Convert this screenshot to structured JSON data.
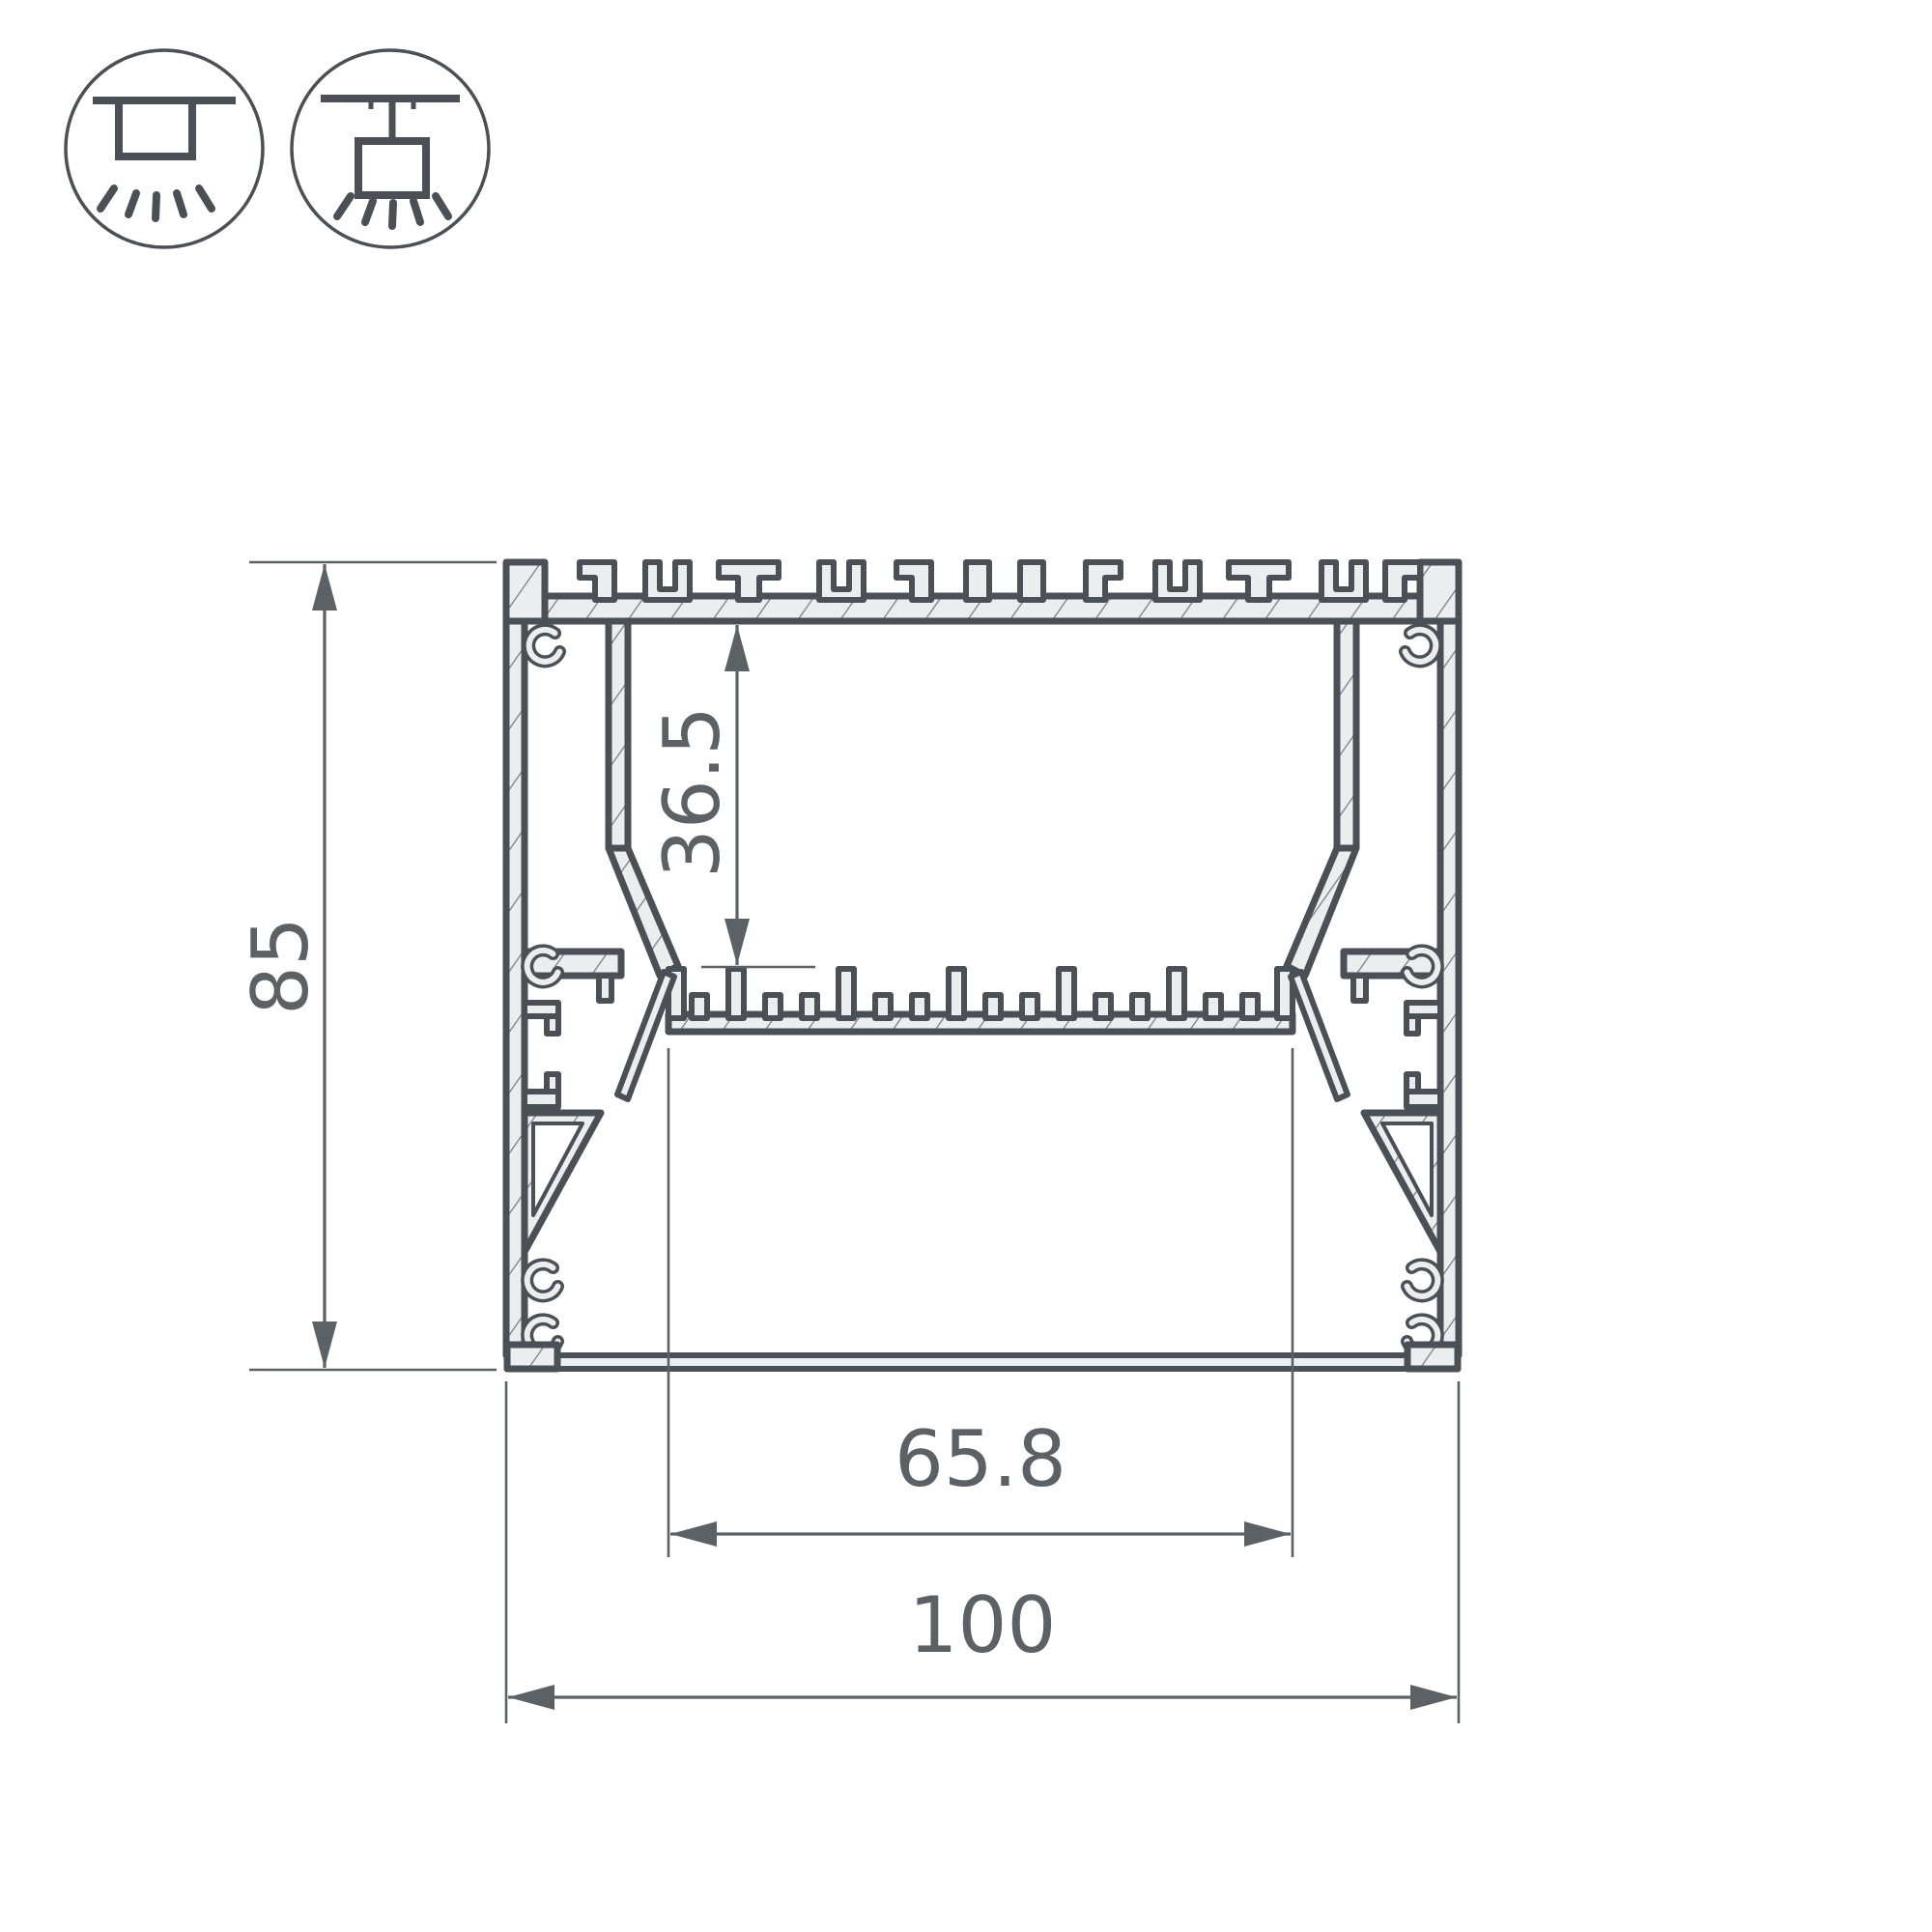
{
  "page": {
    "background": "#ffffff"
  },
  "icons": {
    "items": [
      {
        "name": "surface-ceiling-mount"
      },
      {
        "name": "pendant-suspension-mount"
      }
    ]
  },
  "drawing": {
    "type": "aluminum-led-profile-cross-section",
    "colors": {
      "outline": "#4a5056",
      "material_fill": "#ecedee",
      "hatch_line": "#767c81",
      "dimension_line": "#5c6166"
    },
    "dimensions": {
      "overall_height": {
        "label": "85"
      },
      "cavity_depth": {
        "label": "36.5"
      },
      "opening_width": {
        "label": "65.8"
      },
      "overall_width": {
        "label": "100"
      }
    }
  }
}
